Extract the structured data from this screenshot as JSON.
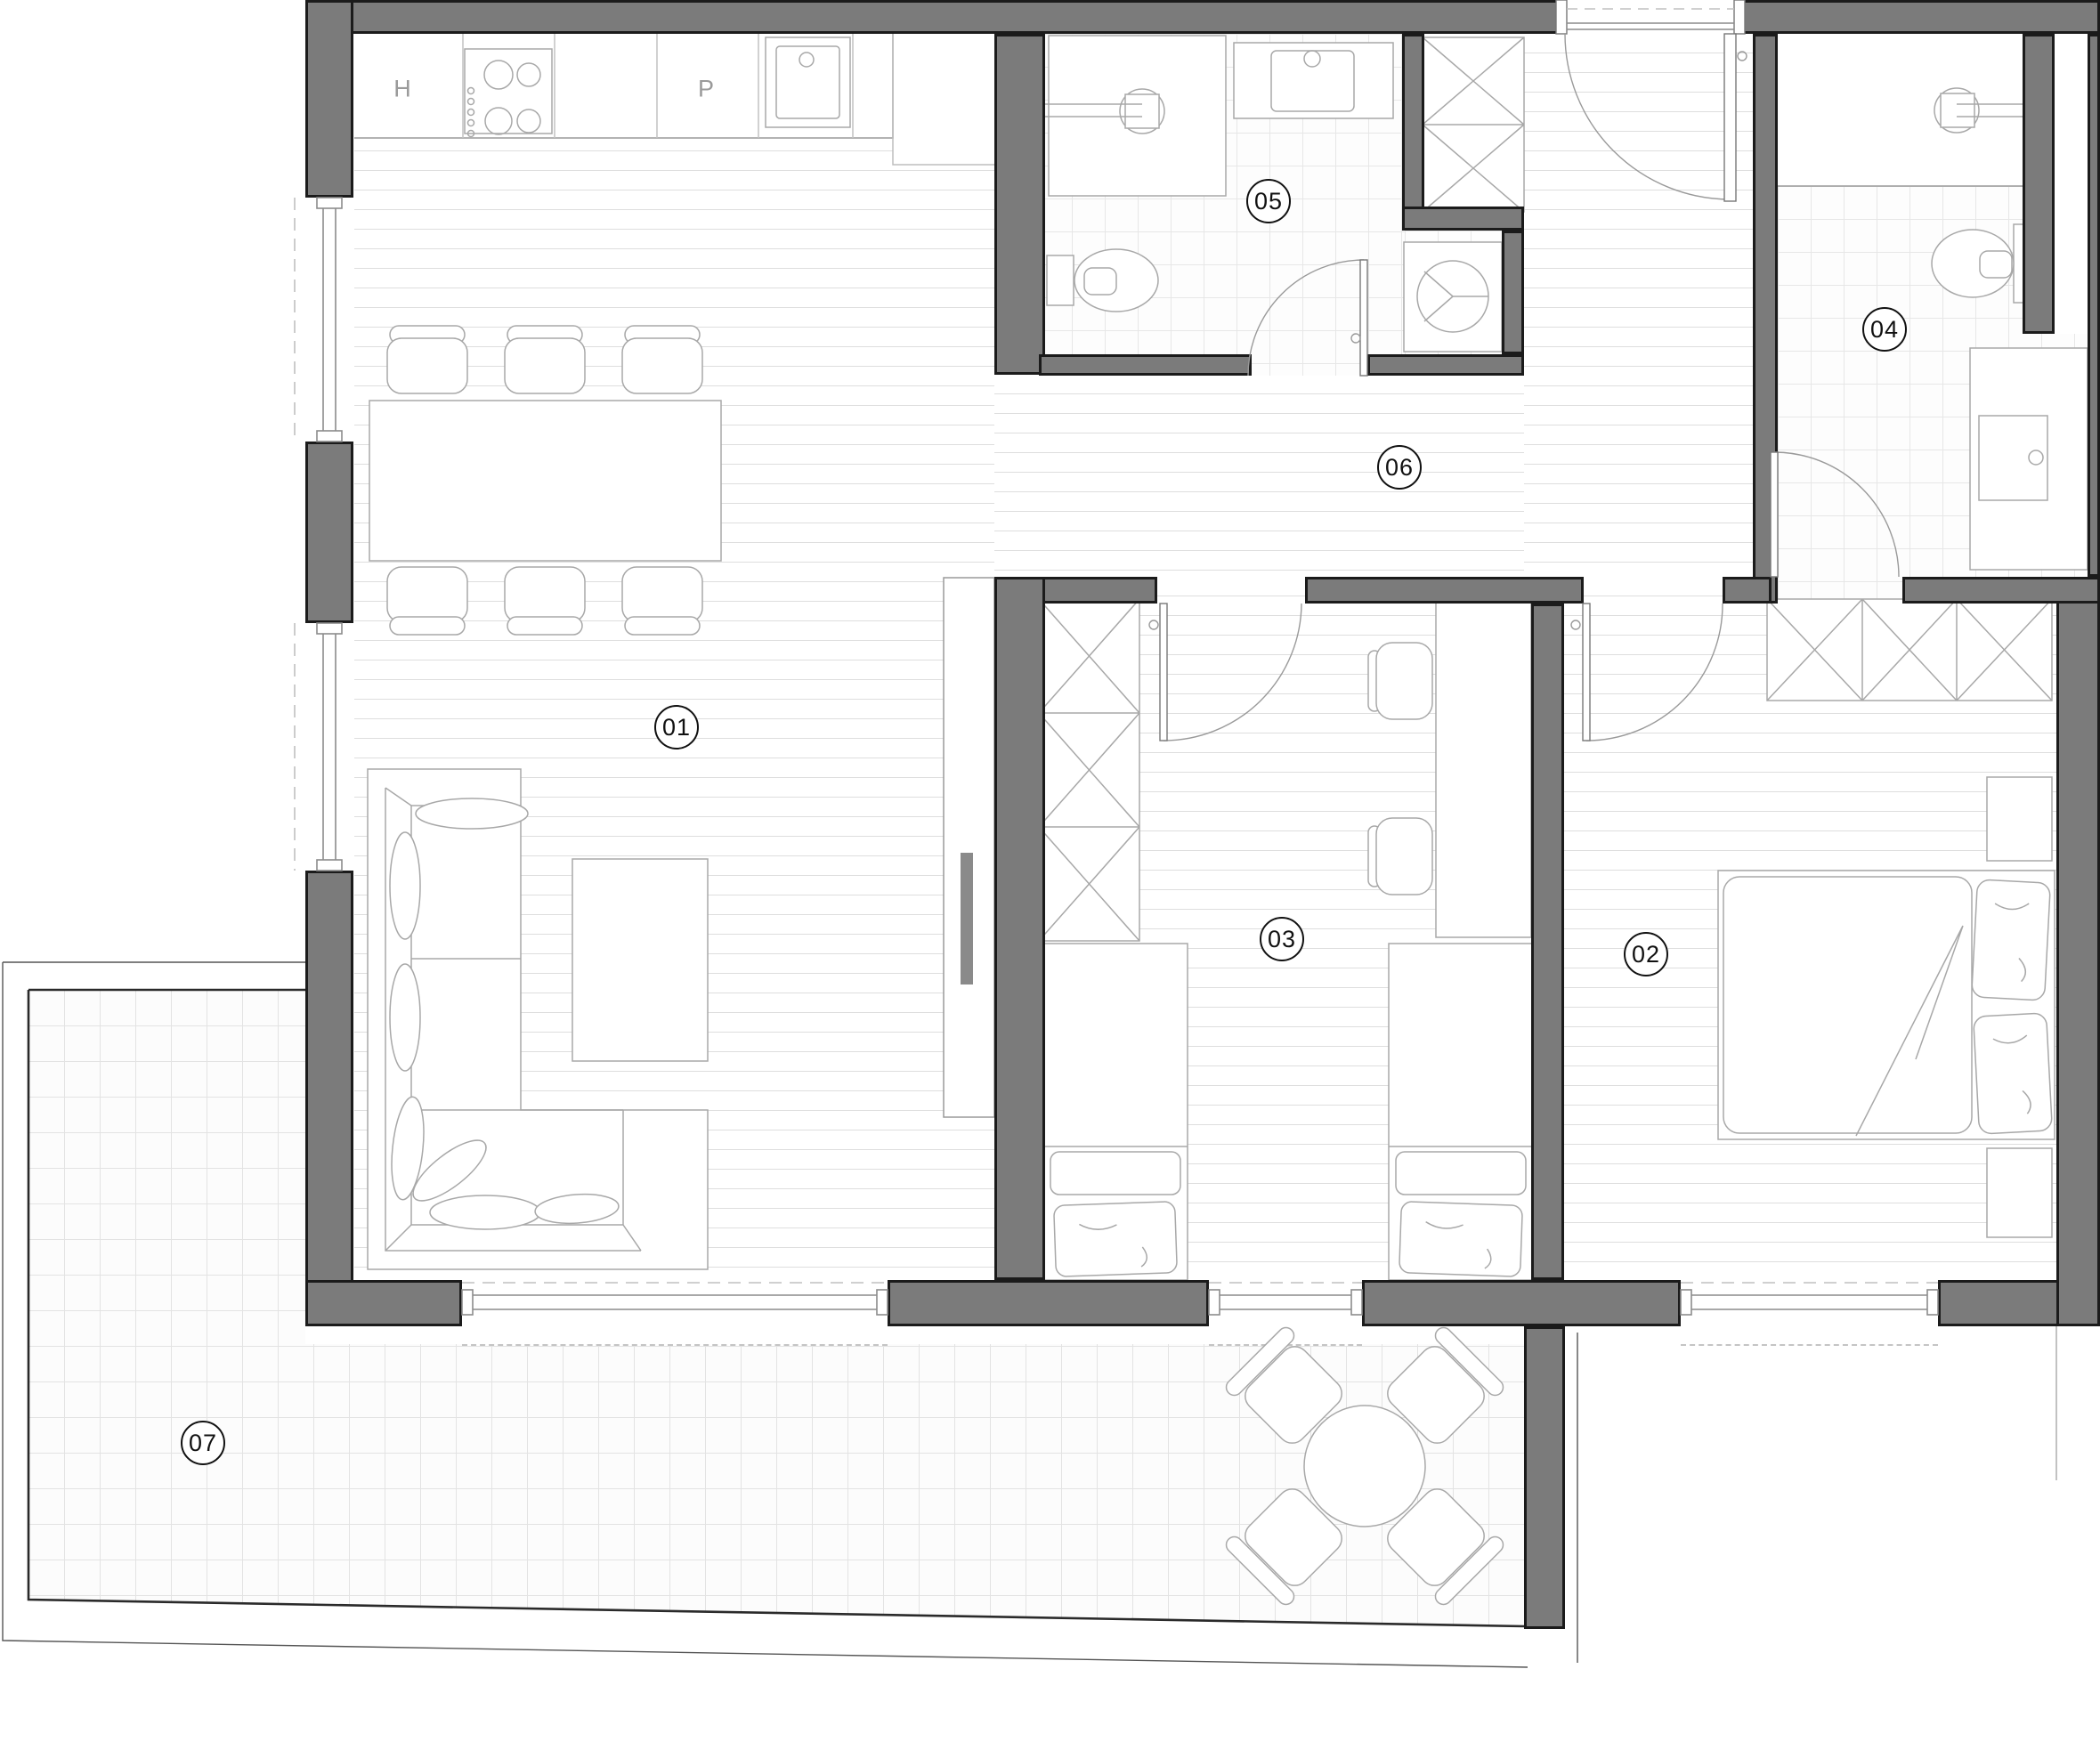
{
  "title": "apartment floor plan",
  "rooms": [
    {
      "id": "01",
      "label": "01"
    },
    {
      "id": "02",
      "label": "02"
    },
    {
      "id": "03",
      "label": "03"
    },
    {
      "id": "04",
      "label": "04"
    },
    {
      "id": "05",
      "label": "05"
    },
    {
      "id": "06",
      "label": "06"
    },
    {
      "id": "07",
      "label": "07"
    }
  ],
  "kitchen": {
    "hob_label": "H",
    "pantry_label": "P"
  },
  "colors": {
    "wall_fill": "#7b7b7b",
    "wall_edge": "#1b1b1b",
    "furniture_line": "#a8a8a8",
    "plank_line": "#dedede",
    "tile_line": "#e7e7e7",
    "label_ink": "#111111"
  }
}
